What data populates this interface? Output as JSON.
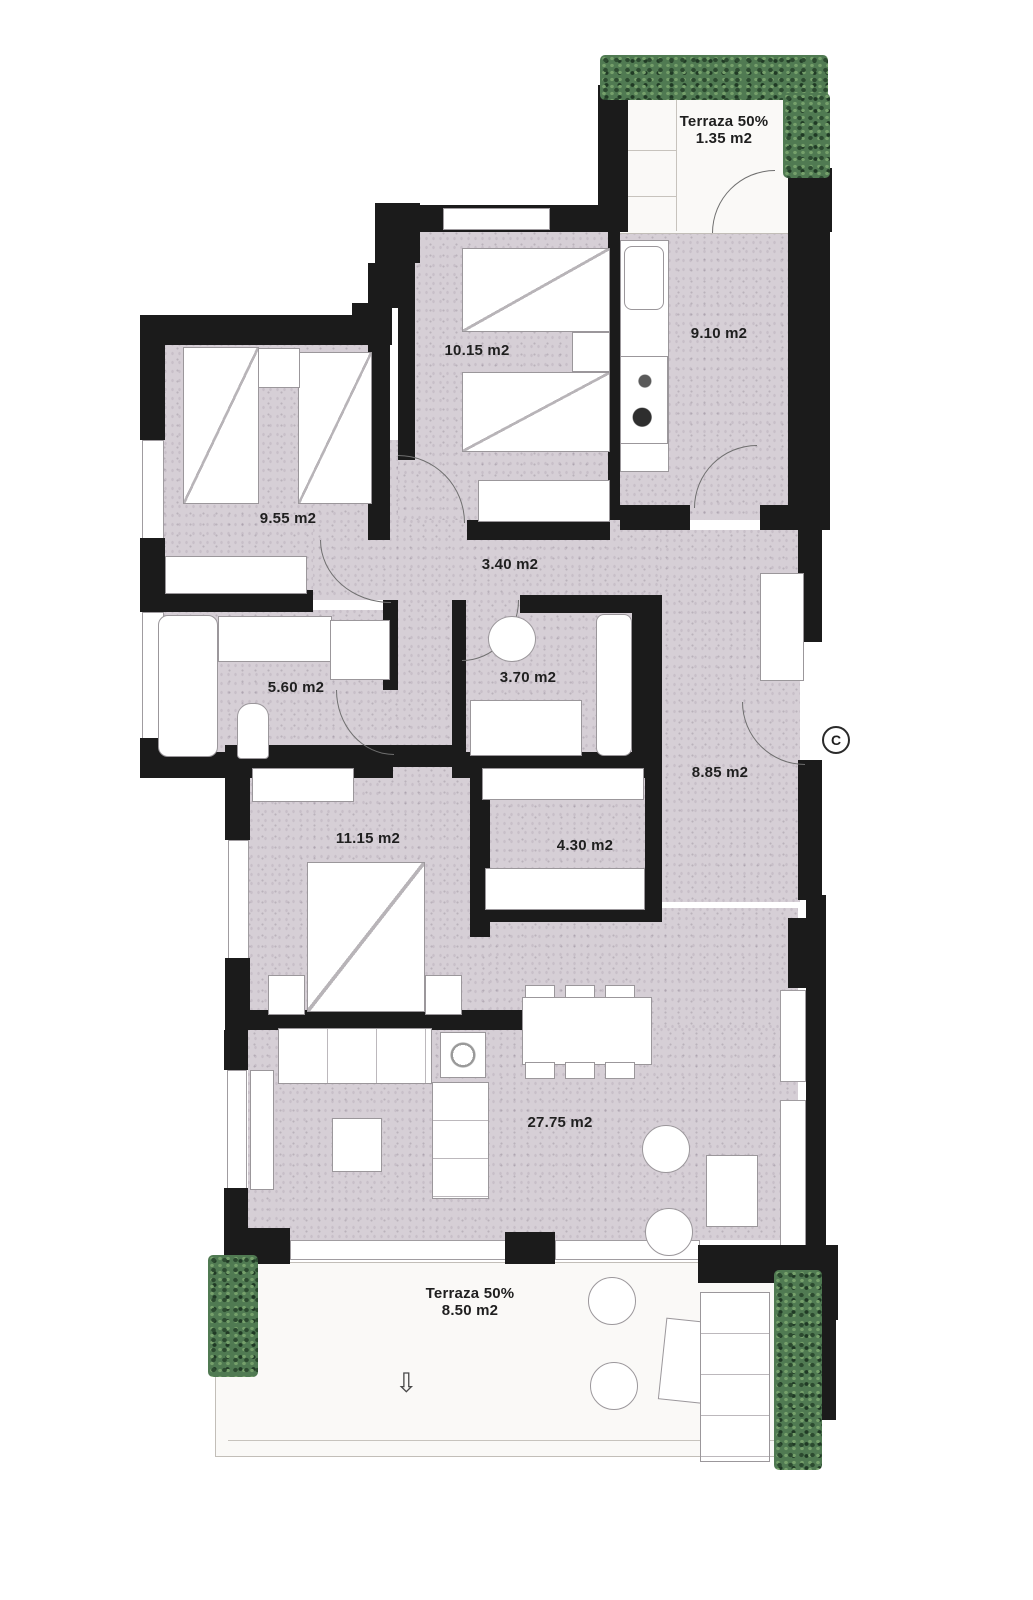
{
  "title": "Apartment floor plan",
  "colors": {
    "wall": "#1b1b1b",
    "floor": "#d6cfd6",
    "terrace_floor": "#faf9f7",
    "hedge": "#507a52"
  },
  "icons": {
    "down_arrow": "⇩"
  },
  "plan": {
    "entrance_label": "C",
    "rooms": [
      {
        "id": "terraza-superior",
        "label": "Terraza 50%",
        "area": "1.35 m2"
      },
      {
        "id": "cocina",
        "area": "9.10 m2"
      },
      {
        "id": "dormitorio-1",
        "area": "10.15 m2"
      },
      {
        "id": "dormitorio-2",
        "area": "9.55 m2"
      },
      {
        "id": "distribuidor",
        "area": "3.40 m2"
      },
      {
        "id": "bano-1",
        "area": "5.60 m2"
      },
      {
        "id": "bano-2",
        "area": "3.70 m2"
      },
      {
        "id": "recibidor",
        "area": "8.85 m2"
      },
      {
        "id": "dormitorio-3",
        "area": "11.15 m2"
      },
      {
        "id": "vestidor",
        "area": "4.30 m2"
      },
      {
        "id": "salon-comedor",
        "area": "27.75 m2"
      },
      {
        "id": "terraza-inferior",
        "label": "Terraza 50%",
        "area": "8.50 m2"
      }
    ]
  }
}
